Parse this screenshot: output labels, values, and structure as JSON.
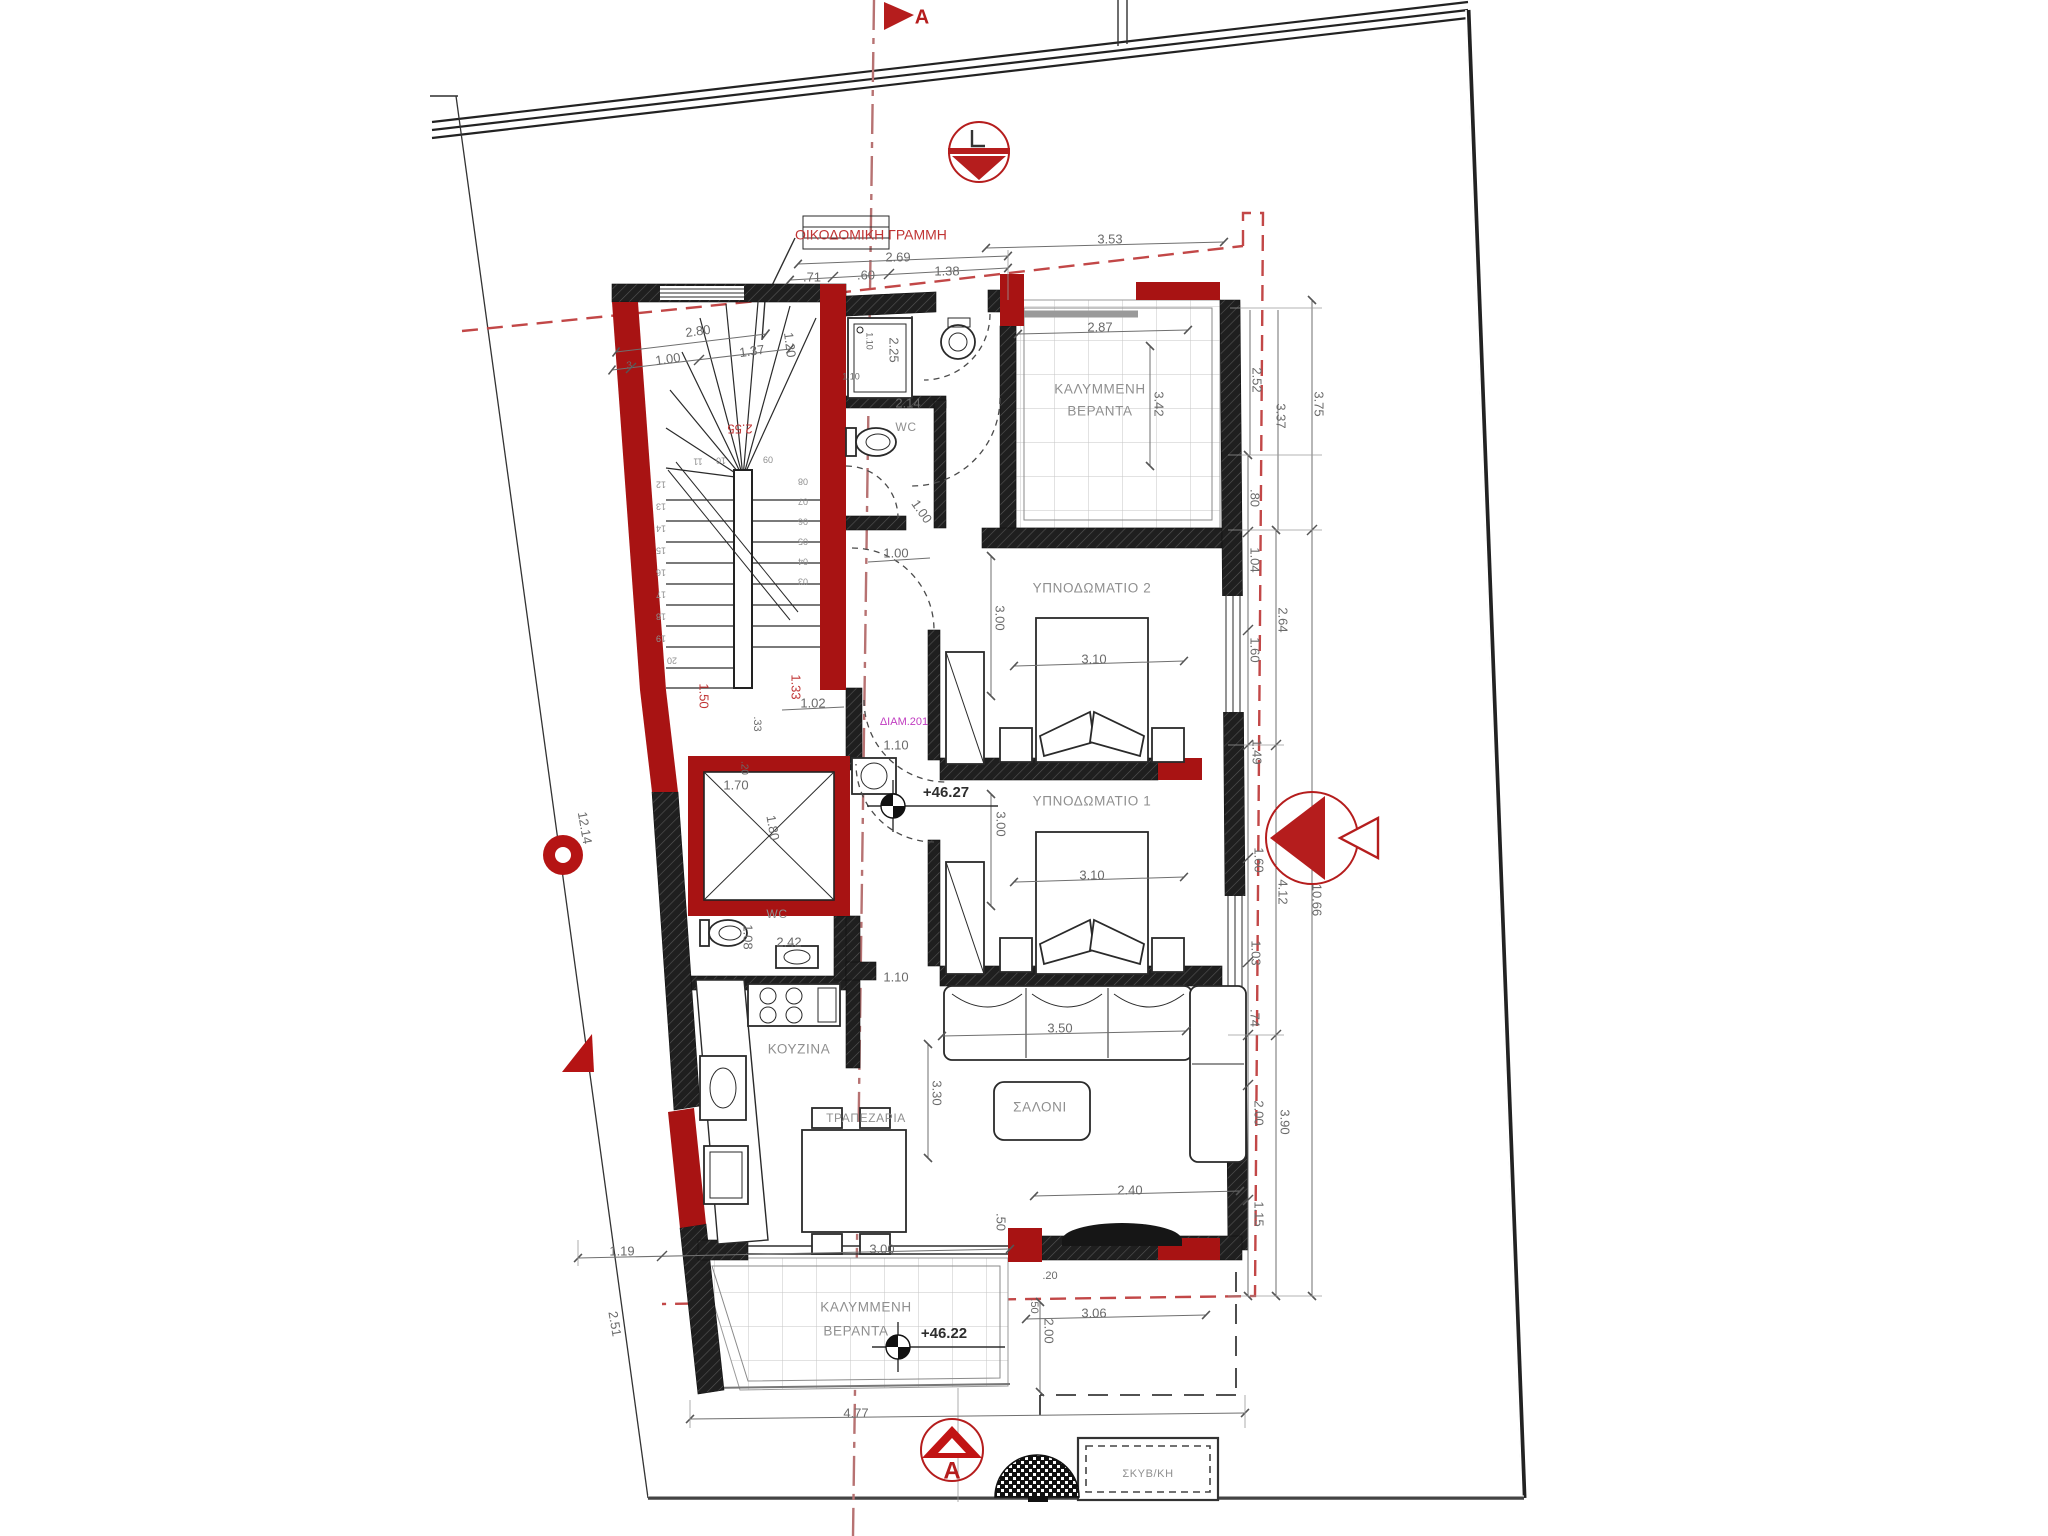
{
  "colors": {
    "wall_dark": "#1f1f1f",
    "wall_red": "#a81313",
    "dim_text": "#6a6a6a",
    "red_text": "#c03434",
    "magenta_text": "#c03cc0",
    "building_line_red": "#c24747",
    "section_line_red": "#b77272",
    "tile_line": "#c6c6c6"
  },
  "plan": {
    "apartment_id": "ΔΙΑΜ.201",
    "section_label": "A",
    "building_line_label": "ΟΙΚΟΔΟΜΙΚΗ ΓΡΑΜΜΗ",
    "outbuilding_label": "ΣΚΥΒ/ΚΗ",
    "levels": [
      "+46.27",
      "+46.22"
    ],
    "rooms": [
      "ΚΑΛΥΜΜΕΝΗ ΒΕΡΑΝΤΑ",
      "WC",
      "ΥΠΝΟΔΩΜΑΤΙΟ 2",
      "ΥΠΝΟΔΩΜΑΤΙΟ 1",
      "WC",
      "ΚΟΥΖΙΝΑ",
      "ΤΡΑΠΕΖΑΡΙΑ",
      "ΣΑΛΟΝΙ",
      "ΚΑΛΥΜΜΕΝΗ ΒΕΡΑΝΤΑ"
    ]
  },
  "annotations": [
    {
      "n": "building-line-label",
      "t": "ΟΙΚΟΔΟΜΙΚΗ ΓΡΑΜΜΗ",
      "x": 795,
      "y": 236,
      "c": "red",
      "s": 14,
      "a": "start"
    },
    {
      "n": "dim-3-53",
      "t": "3.53",
      "x": 1110,
      "y": 240,
      "c": "dim"
    },
    {
      "n": "dim-2-69",
      "t": "2.69",
      "x": 898,
      "y": 258,
      "c": "dim"
    },
    {
      "n": "dim-71",
      "t": ".71",
      "x": 812,
      "y": 278,
      "c": "dim"
    },
    {
      "n": "dim-60",
      "t": ".60",
      "x": 866,
      "y": 276,
      "c": "dim"
    },
    {
      "n": "dim-1-38",
      "t": "1.38",
      "x": 947,
      "y": 272,
      "c": "dim"
    },
    {
      "n": "dim-2-80",
      "t": "2.80",
      "x": 698,
      "y": 332,
      "r": -8,
      "c": "dim"
    },
    {
      "n": "dim-3",
      "t": ".3",
      "x": 628,
      "y": 366,
      "r": -8,
      "c": "dim",
      "s": 10
    },
    {
      "n": "dim-1-00-a",
      "t": "1.00",
      "x": 668,
      "y": 360,
      "r": -8,
      "c": "dim"
    },
    {
      "n": "dim-1-37",
      "t": "1.37",
      "x": 752,
      "y": 352,
      "r": -8,
      "c": "dim"
    },
    {
      "n": "dim-1-20",
      "t": "1.20",
      "x": 789,
      "y": 345,
      "r": 83,
      "c": "dim"
    },
    {
      "n": "dim-2-25",
      "t": "2.25",
      "x": 893,
      "y": 350,
      "r": 90,
      "c": "dim"
    },
    {
      "n": "dim-1-10-a",
      "t": "1.10",
      "x": 869,
      "y": 341,
      "r": 90,
      "c": "dim",
      "s": 9
    },
    {
      "n": "dim-1-10-b",
      "t": "1.10",
      "x": 851,
      "y": 377,
      "c": "dim",
      "s": 9
    },
    {
      "n": "dim-2-14",
      "t": "2.14",
      "x": 908,
      "y": 404,
      "c": "dim"
    },
    {
      "n": "room-wc-1",
      "t": "WC",
      "x": 906,
      "y": 428,
      "c": "room",
      "s": 12
    },
    {
      "n": "dim-2-87",
      "t": "2.87",
      "x": 1100,
      "y": 328,
      "c": "dim"
    },
    {
      "n": "dim-3-42",
      "t": "3.42",
      "x": 1158,
      "y": 404,
      "r": 90,
      "c": "dim"
    },
    {
      "n": "room-veranda-top-1",
      "t": "ΚΑΛΥΜΜΕΝΗ",
      "x": 1100,
      "y": 390,
      "c": "room"
    },
    {
      "n": "room-veranda-top-2",
      "t": "ΒΕΡΑΝΤΑ",
      "x": 1100,
      "y": 412,
      "c": "room"
    },
    {
      "n": "dim-2-52",
      "t": "2.52",
      "x": 1256,
      "y": 380,
      "r": 90,
      "c": "dim"
    },
    {
      "n": "dim-3-37",
      "t": "3.37",
      "x": 1280,
      "y": 416,
      "r": 90,
      "c": "dim"
    },
    {
      "n": "dim-3-75",
      "t": "3.75",
      "x": 1318,
      "y": 404,
      "r": 90,
      "c": "dim"
    },
    {
      "n": "dim-80",
      "t": ".80",
      "x": 1254,
      "y": 498,
      "r": 90,
      "c": "dim"
    },
    {
      "n": "dim-1-04",
      "t": "1.04",
      "x": 1254,
      "y": 560,
      "r": 90,
      "c": "dim"
    },
    {
      "n": "dim-2-64",
      "t": "2.64",
      "x": 1282,
      "y": 620,
      "r": 90,
      "c": "dim"
    },
    {
      "n": "dim-1-60-a",
      "t": "1.60",
      "x": 1254,
      "y": 650,
      "r": 90,
      "c": "dim"
    },
    {
      "n": "dim-1-49",
      "t": "1.49",
      "x": 1256,
      "y": 752,
      "r": 90,
      "c": "dim"
    },
    {
      "n": "dim-1-60-b",
      "t": "1.60",
      "x": 1258,
      "y": 860,
      "r": 90,
      "c": "dim"
    },
    {
      "n": "dim-4-12",
      "t": "4.12",
      "x": 1282,
      "y": 892,
      "r": 90,
      "c": "dim"
    },
    {
      "n": "dim-10-66",
      "t": "10.66",
      "x": 1316,
      "y": 900,
      "r": 90,
      "c": "dim"
    },
    {
      "n": "dim-1-03",
      "t": "1.03",
      "x": 1255,
      "y": 953,
      "r": 90,
      "c": "dim"
    },
    {
      "n": "dim-74",
      "t": ".74",
      "x": 1254,
      "y": 1018,
      "r": 90,
      "c": "dim"
    },
    {
      "n": "dim-2-00-a",
      "t": "2.00",
      "x": 1258,
      "y": 1113,
      "r": 90,
      "c": "dim"
    },
    {
      "n": "dim-3-90",
      "t": "3.90",
      "x": 1284,
      "y": 1122,
      "r": 90,
      "c": "dim"
    },
    {
      "n": "dim-1-15",
      "t": "1.15",
      "x": 1258,
      "y": 1214,
      "r": 90,
      "c": "dim"
    },
    {
      "n": "room-bedroom-2",
      "t": "ΥΠΝΟΔΩΜΑΤΙΟ 2",
      "x": 1092,
      "y": 589,
      "c": "room"
    },
    {
      "n": "dim-3-00-a",
      "t": "3.00",
      "x": 999,
      "y": 618,
      "r": 90,
      "c": "dim"
    },
    {
      "n": "dim-3-10-a",
      "t": "3.10",
      "x": 1094,
      "y": 660,
      "c": "dim"
    },
    {
      "n": "dim-1-00-b",
      "t": "1.00",
      "x": 921,
      "y": 512,
      "r": 55,
      "c": "dim"
    },
    {
      "n": "dim-1-00-c",
      "t": "1.00",
      "x": 896,
      "y": 554,
      "c": "dim"
    },
    {
      "n": "dim-2-55",
      "t": "2.55",
      "x": 740,
      "y": 428,
      "r": 180,
      "c": "red"
    },
    {
      "n": "dim-1-50",
      "t": "1.50",
      "x": 703,
      "y": 696,
      "r": 90,
      "c": "red"
    },
    {
      "n": "dim-1-33",
      "t": "1.33",
      "x": 795,
      "y": 687,
      "r": 90,
      "c": "red"
    },
    {
      "n": "dim-1-02",
      "t": "1.02",
      "x": 813,
      "y": 704,
      "c": "dim"
    },
    {
      "n": "dim-33",
      "t": ".33",
      "x": 757,
      "y": 724,
      "r": 90,
      "c": "dim",
      "s": 11
    },
    {
      "n": "apartment-id-label",
      "t": "ΔΙΑΜ.201",
      "x": 904,
      "y": 722,
      "c": "magenta",
      "s": 11
    },
    {
      "n": "dim-1-10-c",
      "t": "1.10",
      "x": 896,
      "y": 746,
      "c": "dim"
    },
    {
      "n": "dim-20-a",
      "t": ".20",
      "x": 744,
      "y": 768,
      "r": 90,
      "c": "dim",
      "s": 10
    },
    {
      "n": "dim-1-70",
      "t": "1.70",
      "x": 736,
      "y": 786,
      "c": "dim"
    },
    {
      "n": "dim-1-80",
      "t": "1.80",
      "x": 772,
      "y": 828,
      "r": 80,
      "c": "dim"
    },
    {
      "n": "level-46-27",
      "t": "+46.27",
      "x": 946,
      "y": 793,
      "c": "level"
    },
    {
      "n": "room-bedroom-1",
      "t": "ΥΠΝΟΔΩΜΑΤΙΟ 1",
      "x": 1092,
      "y": 802,
      "c": "room"
    },
    {
      "n": "dim-3-00-b",
      "t": "3.00",
      "x": 1000,
      "y": 824,
      "r": 90,
      "c": "dim"
    },
    {
      "n": "dim-3-10-b",
      "t": "3.10",
      "x": 1092,
      "y": 876,
      "c": "dim"
    },
    {
      "n": "room-wc-2",
      "t": "WC",
      "x": 777,
      "y": 915,
      "c": "room",
      "s": 12
    },
    {
      "n": "dim-1-08",
      "t": "1.08",
      "x": 747,
      "y": 937,
      "r": 90,
      "c": "dim"
    },
    {
      "n": "dim-2-42",
      "t": "2.42",
      "x": 789,
      "y": 943,
      "c": "dim"
    },
    {
      "n": "dim-1-10-d",
      "t": "1.10",
      "x": 896,
      "y": 978,
      "c": "dim"
    },
    {
      "n": "dim-3-50",
      "t": "3.50",
      "x": 1060,
      "y": 1029,
      "c": "dim"
    },
    {
      "n": "room-kitchen",
      "t": "ΚΟΥΖΙΝΑ",
      "x": 799,
      "y": 1050,
      "c": "room"
    },
    {
      "n": "dim-3-30",
      "t": "3.30",
      "x": 936,
      "y": 1093,
      "r": 90,
      "c": "dim"
    },
    {
      "n": "room-dining",
      "t": "ΤΡΑΠΕΖΑΡΙΑ",
      "x": 866,
      "y": 1119,
      "c": "room",
      "s": 12
    },
    {
      "n": "room-living",
      "t": "ΣΑΛΟΝΙ",
      "x": 1040,
      "y": 1108,
      "c": "room"
    },
    {
      "n": "dim-2-40",
      "t": "2.40",
      "x": 1130,
      "y": 1191,
      "c": "dim"
    },
    {
      "n": "dim-50-a",
      "t": ".50",
      "x": 1000,
      "y": 1222,
      "r": 90,
      "c": "dim"
    },
    {
      "n": "dim-1-19",
      "t": "1.19",
      "x": 622,
      "y": 1252,
      "c": "dim"
    },
    {
      "n": "dim-3-00-c",
      "t": "3.00",
      "x": 882,
      "y": 1250,
      "c": "dim"
    },
    {
      "n": "dim-20-b",
      "t": ".20",
      "x": 1050,
      "y": 1276,
      "c": "dim",
      "s": 11
    },
    {
      "n": "dim-50-b",
      "t": ".50",
      "x": 1034,
      "y": 1306,
      "r": 90,
      "c": "dim",
      "s": 11
    },
    {
      "n": "room-veranda-bottom-1",
      "t": "ΚΑΛΥΜΜΕΝΗ",
      "x": 866,
      "y": 1308,
      "c": "room"
    },
    {
      "n": "room-veranda-bottom-2",
      "t": "ΒΕΡΑΝΤΑ",
      "x": 856,
      "y": 1332,
      "c": "room"
    },
    {
      "n": "level-46-22",
      "t": "+46.22",
      "x": 944,
      "y": 1334,
      "c": "level"
    },
    {
      "n": "dim-2-00-b",
      "t": "2.00",
      "x": 1048,
      "y": 1331,
      "r": 90,
      "c": "dim"
    },
    {
      "n": "dim-3-06",
      "t": "3.06",
      "x": 1094,
      "y": 1314,
      "c": "dim"
    },
    {
      "n": "dim-12-14",
      "t": "12.14",
      "x": 584,
      "y": 828,
      "r": 80,
      "c": "dim"
    },
    {
      "n": "dim-2-51",
      "t": "2.51",
      "x": 614,
      "y": 1324,
      "r": 80,
      "c": "dim"
    },
    {
      "n": "dim-4-77",
      "t": "4.77",
      "x": 856,
      "y": 1414,
      "c": "dim"
    },
    {
      "n": "outbuilding-label",
      "t": "ΣΚΥΒ/ΚΗ",
      "x": 1148,
      "y": 1474,
      "c": "room",
      "s": 11
    },
    {
      "n": "section-a-top",
      "t": "A",
      "x": 922,
      "y": 18,
      "c": "marker"
    },
    {
      "n": "section-a-bottom",
      "t": "A",
      "x": 952,
      "y": 1472,
      "c": "marker",
      "s": 24
    },
    {
      "n": "stair-num-11",
      "t": "11",
      "x": 698,
      "y": 461,
      "r": 180,
      "c": "stair"
    },
    {
      "n": "stair-num-10",
      "t": "10",
      "x": 721,
      "y": 460,
      "r": 180,
      "c": "stair"
    },
    {
      "n": "stair-num-09",
      "t": "09",
      "x": 768,
      "y": 459,
      "r": 180,
      "c": "stair"
    },
    {
      "n": "stair-num-12",
      "t": "12",
      "x": 661,
      "y": 484,
      "r": 180,
      "c": "stair"
    },
    {
      "n": "stair-num-13",
      "t": "13",
      "x": 661,
      "y": 506,
      "r": 180,
      "c": "stair"
    },
    {
      "n": "stair-num-14",
      "t": "14",
      "x": 661,
      "y": 528,
      "r": 180,
      "c": "stair"
    },
    {
      "n": "stair-num-15",
      "t": "15",
      "x": 661,
      "y": 550,
      "r": 180,
      "c": "stair"
    },
    {
      "n": "stair-num-16",
      "t": "16",
      "x": 661,
      "y": 572,
      "r": 180,
      "c": "stair"
    },
    {
      "n": "stair-num-17",
      "t": "17",
      "x": 661,
      "y": 594,
      "r": 180,
      "c": "stair"
    },
    {
      "n": "stair-num-18",
      "t": "18",
      "x": 661,
      "y": 616,
      "r": 180,
      "c": "stair"
    },
    {
      "n": "stair-num-19",
      "t": "19",
      "x": 661,
      "y": 638,
      "r": 180,
      "c": "stair"
    },
    {
      "n": "stair-num-20",
      "t": "20",
      "x": 672,
      "y": 660,
      "r": 180,
      "c": "stair"
    },
    {
      "n": "stair-num-08",
      "t": "08",
      "x": 803,
      "y": 481,
      "r": 180,
      "c": "stair"
    },
    {
      "n": "stair-num-07",
      "t": "07",
      "x": 803,
      "y": 501,
      "r": 180,
      "c": "stair"
    },
    {
      "n": "stair-num-06",
      "t": "06",
      "x": 803,
      "y": 521,
      "r": 180,
      "c": "stair"
    },
    {
      "n": "stair-num-05",
      "t": "05",
      "x": 803,
      "y": 541,
      "r": 180,
      "c": "stair"
    },
    {
      "n": "stair-num-04",
      "t": "04",
      "x": 803,
      "y": 561,
      "r": 180,
      "c": "stair"
    },
    {
      "n": "stair-num-03",
      "t": "03",
      "x": 803,
      "y": 581,
      "r": 180,
      "c": "stair"
    }
  ]
}
